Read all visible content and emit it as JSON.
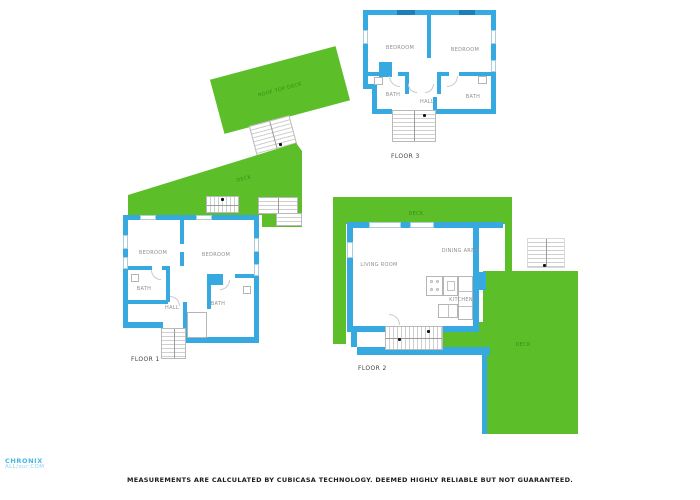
{
  "colors": {
    "deck_green": "#5cbe28",
    "deck_text_green": "#3c8c14",
    "wall_blue": "#36a9e1",
    "window_dark_blue": "#1d7fb5",
    "stair_gray": "#cfcfcf",
    "room_label_gray": "#8f8f8f"
  },
  "floor3": {
    "name": "FLOOR 3",
    "bedroom_left": "BEDROOM",
    "bedroom_right": "BEDROOM",
    "bath_left": "BATH",
    "hall": "HALL",
    "bath_right": "BATH"
  },
  "floor1": {
    "name": "FLOOR 1",
    "bedroom_left": "BEDROOM",
    "bedroom_right": "BEDROOM",
    "bath_left": "BATH",
    "bath_right": "BATH",
    "hall": "HALL"
  },
  "floor2": {
    "name": "FLOOR 2",
    "living_room": "LIVING ROOM",
    "dining_area": "DINING AREA",
    "kitchen": "KITCHEN",
    "deck_top": "DECK",
    "deck_right": "DECK"
  },
  "rooftop_deck": {
    "label": "ROOF TOP DECK"
  },
  "floor1_deck": {
    "label": "DECK"
  },
  "watermark": {
    "line1": "CHRONIX",
    "line2": "ALL/our.COM"
  },
  "disclaimer": "MEASUREMENTS ARE CALCULATED BY CUBICASA TECHNOLOGY. DEEMED HIGHLY RELIABLE BUT NOT GUARANTEED."
}
